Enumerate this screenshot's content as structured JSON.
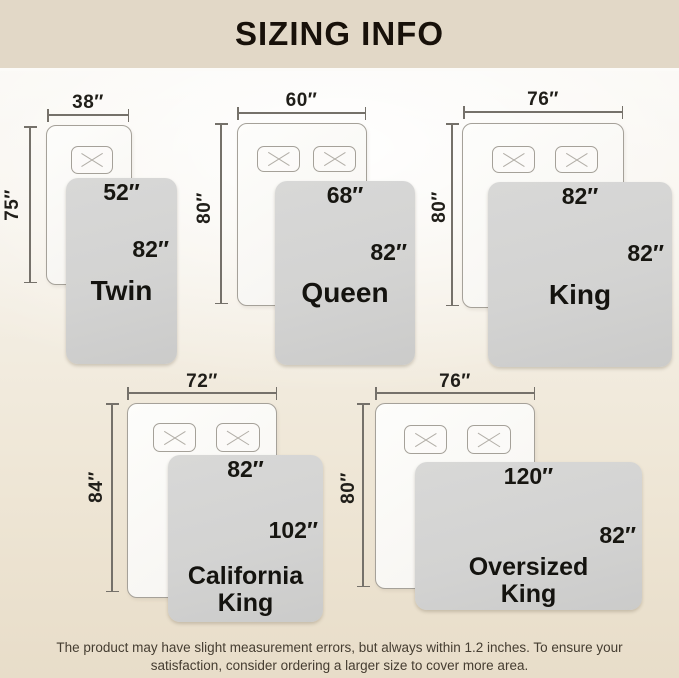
{
  "header": {
    "title": "SIZING INFO"
  },
  "sizes": [
    {
      "name": "Twin",
      "mattress_width": "38″",
      "mattress_length": "75″",
      "blanket_width": "52″",
      "blanket_length": "82″"
    },
    {
      "name": "Queen",
      "mattress_width": "60″",
      "mattress_length": "80″",
      "blanket_width": "68″",
      "blanket_length": "82″"
    },
    {
      "name": "King",
      "mattress_width": "76″",
      "mattress_length": "80″",
      "blanket_width": "82″",
      "blanket_length": "82″"
    },
    {
      "name": "California\nKing",
      "mattress_width": "72″",
      "mattress_length": "84″",
      "blanket_width": "82″",
      "blanket_length": "102″"
    },
    {
      "name": "Oversized\nKing",
      "mattress_width": "76″",
      "mattress_length": "80″",
      "blanket_width": "120″",
      "blanket_length": "82″"
    }
  ],
  "footer": {
    "line1": "The product may have slight measurement errors, but always within 1.2 inches. To ensure your",
    "line2": "satisfaction, consider ordering a larger size to cover more area."
  },
  "colors": {
    "header_bg": "#e2d8c7",
    "background_beige": "#e8ddc9",
    "blanket_gray": "#d3d3d2",
    "mattress_white": "#fbfaf7",
    "dimension_line": "#75716a",
    "text_dark": "#18110a"
  }
}
